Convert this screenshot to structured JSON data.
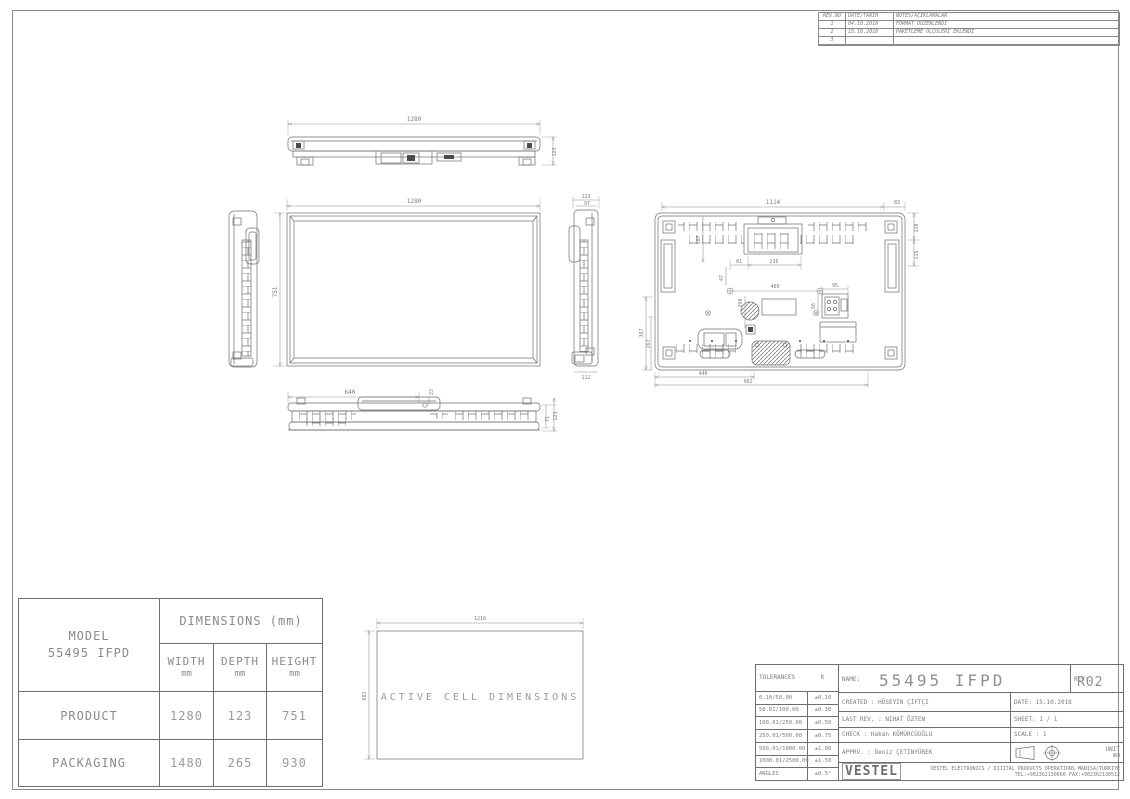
{
  "revision_table": {
    "headers": [
      "REV.NO",
      "DATE/TARİH",
      "NOTES/AÇIKLAMALAR"
    ],
    "rows": [
      {
        "no": "1",
        "date": "04.10.2018",
        "note": "FORMAT DÜZENLENDİ"
      },
      {
        "no": "2",
        "date": "15.10.2018",
        "note": "PAKETLEME ÖLÇÜLERİ EKLENDİ"
      },
      {
        "no": "3",
        "date": "",
        "note": ""
      }
    ]
  },
  "drawings": {
    "top_view": {
      "width": "1280",
      "depth": "123"
    },
    "front_view": {
      "width": "1280",
      "height": "751"
    },
    "side_right": {
      "depth": "123",
      "inner_depth": "97",
      "bottom": "112"
    },
    "back_view": {
      "top_width": "1114",
      "top_right": "83",
      "right_upper": "120",
      "right_lower": "115",
      "handle_offset": "187",
      "handle_left": "81",
      "handle_width": "236",
      "mount_width": "400",
      "mount_offset": "47",
      "center_height": "290",
      "connector_width": "95",
      "connector_height": "66",
      "left_height_outer": "367",
      "left_height_inner": "267",
      "bottom_left": "440",
      "bottom_width": "962"
    },
    "bottom_view": {
      "stand_width": "640",
      "stand_offset": "23",
      "height_inner": "71",
      "height_outer": "123"
    },
    "active_cell": {
      "width": "1210",
      "height": "681",
      "label": "ACTIVE CELL DIMENSIONS"
    }
  },
  "dimensions_table": {
    "model_label": "MODEL",
    "model_value": "55495 IFPD",
    "title": "DIMENSIONS (mm)",
    "columns": [
      {
        "label": "WIDTH",
        "unit": "mm"
      },
      {
        "label": "DEPTH",
        "unit": "mm"
      },
      {
        "label": "HEIGHT",
        "unit": "mm"
      }
    ],
    "rows": [
      {
        "label": "PRODUCT",
        "width": "1280",
        "depth": "123",
        "height": "751"
      },
      {
        "label": "PACKAGING",
        "width": "1480",
        "depth": "265",
        "height": "930"
      }
    ]
  },
  "title_block": {
    "tolerances": {
      "header_left": "TOLERANCES",
      "header_right": "K",
      "rows": [
        {
          "range": "0.10/50.00",
          "tol": "±0.10"
        },
        {
          "range": "50.01/100.00",
          "tol": "±0.30"
        },
        {
          "range": "100.01/250.00",
          "tol": "±0.50"
        },
        {
          "range": "250.01/500.00",
          "tol": "±0.75"
        },
        {
          "range": "500.01/1000.00",
          "tol": "±1.00"
        },
        {
          "range": "1000.01/2500.00",
          "tol": "±1.50"
        },
        {
          "range": "ANGLES",
          "tol": "±0.5°"
        }
      ]
    },
    "name_label": "NAME:",
    "name_value": "55495 IFPD",
    "rev_label": "REV:",
    "rev_value": "R02",
    "created": "CREATED : HÜSEYİN ÇİFTÇİ",
    "date": "DATE: 15.10.2018",
    "last_rev": "LAST REV. : NIHAT ÖZTEN",
    "sheet": "SHEET: 1 / 1",
    "check": "CHECK : Hakan KÖMÜRCÜOĞLU",
    "scale": "SCALE : 1",
    "apprv": "APPRV. : Deniz ÇETİNYÜREK",
    "unit_label": "UNIT",
    "unit_value": "mm",
    "logo": "VESTEL",
    "company_line1": "VESTEL ELECTRONICS / DIJITAL PRODUCTS OPERATIONS MANISA/TURKIYE",
    "company_line2": "TEL:+902362130660 FAX:+902362130512"
  }
}
